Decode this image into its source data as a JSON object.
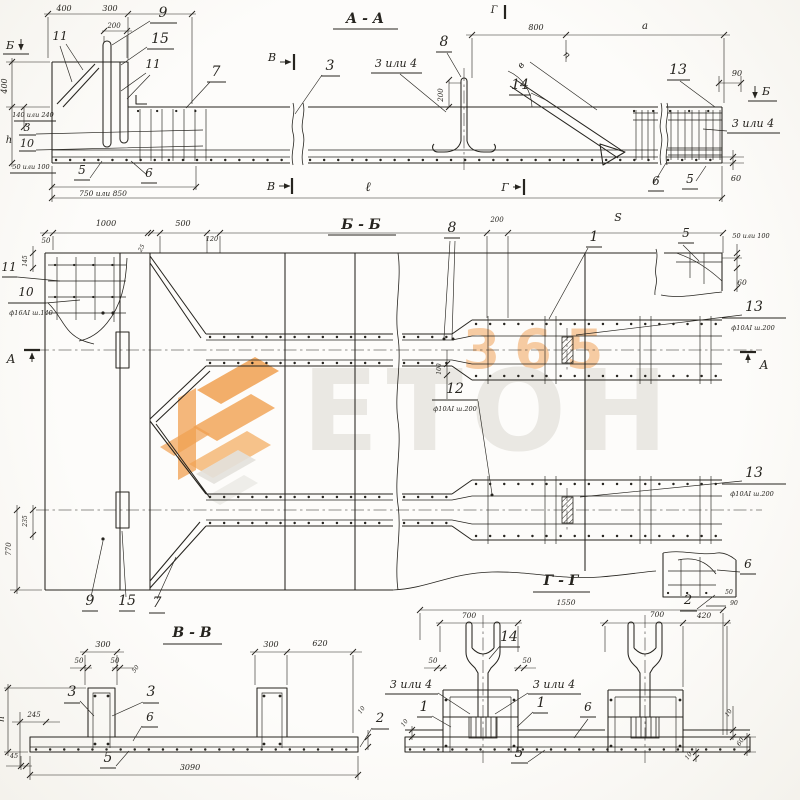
{
  "colors": {
    "ink": "#26241f",
    "paper": "#fdfcfa",
    "watermark_orange": "#f0a050",
    "watermark_gray": "#e8e6e1"
  },
  "watermark": {
    "digits": "365",
    "word": "ЕТОН"
  },
  "annotations": {
    "aa": [
      {
        "n": "title",
        "t": "А - А",
        "x": 365,
        "y": 23,
        "fs": 14,
        "b": 1
      },
      {
        "n": "mark-b-left",
        "t": "Б",
        "x": 10,
        "y": 49,
        "fs": 11
      },
      {
        "n": "dim-400-top",
        "t": "400",
        "x": 64,
        "y": 11,
        "fs": 8
      },
      {
        "n": "dim-300-top",
        "t": "300",
        "x": 110,
        "y": 11,
        "fs": 8
      },
      {
        "n": "dim-200-top",
        "t": "200",
        "x": 114,
        "y": 28,
        "fs": 7
      },
      {
        "n": "callout-9",
        "t": "9",
        "x": 163,
        "y": 17,
        "fs": 14
      },
      {
        "n": "callout-15",
        "t": "15",
        "x": 160,
        "y": 43,
        "fs": 14
      },
      {
        "n": "callout-11a",
        "t": "11",
        "x": 60,
        "y": 40,
        "fs": 12
      },
      {
        "n": "callout-11b",
        "t": "11",
        "x": 153,
        "y": 68,
        "fs": 12
      },
      {
        "n": "callout-7",
        "t": "7",
        "x": 216,
        "y": 76,
        "fs": 14
      },
      {
        "n": "dim-400-left",
        "t": "400",
        "x": 7,
        "y": 86,
        "fs": 8,
        "r": -90
      },
      {
        "n": "dim-140-240",
        "t": "140 или 240",
        "x": 33,
        "y": 117,
        "fs": 6.5
      },
      {
        "n": "callout-3a",
        "t": "3",
        "x": 27,
        "y": 131,
        "fs": 11
      },
      {
        "n": "callout-10",
        "t": "10",
        "x": 27,
        "y": 147,
        "fs": 11
      },
      {
        "n": "dim-h",
        "t": "h",
        "x": 9,
        "y": 143,
        "fs": 10
      },
      {
        "n": "dim-50-100",
        "t": "50 или 100",
        "x": 31,
        "y": 169,
        "fs": 6.5
      },
      {
        "n": "callout-5a",
        "t": "5",
        "x": 82,
        "y": 174,
        "fs": 12
      },
      {
        "n": "callout-6a",
        "t": "6",
        "x": 149,
        "y": 177,
        "fs": 12
      },
      {
        "n": "dim-750-850",
        "t": "750 или 850",
        "x": 103,
        "y": 196,
        "fs": 7.5
      },
      {
        "n": "mark-v-top",
        "t": "В",
        "x": 272,
        "y": 61,
        "fs": 11
      },
      {
        "n": "callout-3b",
        "t": "3",
        "x": 330,
        "y": 70,
        "fs": 14
      },
      {
        "n": "callout-3or4a",
        "t": "3 или 4",
        "x": 396,
        "y": 67,
        "fs": 11
      },
      {
        "n": "callout-8",
        "t": "8",
        "x": 444,
        "y": 46,
        "fs": 14
      },
      {
        "n": "dim-200-mid",
        "t": "200",
        "x": 443,
        "y": 95,
        "fs": 7,
        "r": -90
      },
      {
        "n": "dim-800",
        "t": "800",
        "x": 536,
        "y": 30,
        "fs": 8
      },
      {
        "n": "dim-a",
        "t": "а",
        "x": 645,
        "y": 29,
        "fs": 10
      },
      {
        "n": "dim-n",
        "t": "п",
        "x": 565,
        "y": 57,
        "fs": 9,
        "r": 42
      },
      {
        "n": "dim-v-angle",
        "t": "в",
        "x": 523,
        "y": 67,
        "fs": 9,
        "r": -50
      },
      {
        "n": "callout-14",
        "t": "14",
        "x": 520,
        "y": 89,
        "fs": 14
      },
      {
        "n": "mark-g-top",
        "t": "Г",
        "x": 494,
        "y": 13,
        "fs": 10
      },
      {
        "n": "callout-13",
        "t": "13",
        "x": 678,
        "y": 74,
        "fs": 14
      },
      {
        "n": "dim-90",
        "t": "90",
        "x": 737,
        "y": 76,
        "fs": 8
      },
      {
        "n": "mark-b-right",
        "t": "Б",
        "x": 766,
        "y": 95,
        "fs": 11
      },
      {
        "n": "callout-3or4b",
        "t": "3 или 4",
        "x": 753,
        "y": 127,
        "fs": 11
      },
      {
        "n": "callout-6b",
        "t": "6",
        "x": 656,
        "y": 185,
        "fs": 12
      },
      {
        "n": "callout-5b",
        "t": "5",
        "x": 690,
        "y": 183,
        "fs": 12
      },
      {
        "n": "dim-60",
        "t": "60",
        "x": 736,
        "y": 181,
        "fs": 8
      },
      {
        "n": "mark-v-bot",
        "t": "В",
        "x": 271,
        "y": 190,
        "fs": 11
      },
      {
        "n": "dim-length",
        "t": "ℓ",
        "x": 368,
        "y": 191,
        "fs": 13
      },
      {
        "n": "mark-g-bot",
        "t": "Г",
        "x": 505,
        "y": 191,
        "fs": 11
      }
    ],
    "bb": [
      {
        "n": "title",
        "t": "Б - Б",
        "x": 361,
        "y": 229,
        "fs": 14,
        "b": 1
      },
      {
        "n": "dim-50",
        "t": "50",
        "x": 46,
        "y": 243,
        "fs": 7
      },
      {
        "n": "dim-1000",
        "t": "1000",
        "x": 106,
        "y": 226,
        "fs": 8
      },
      {
        "n": "dim-500",
        "t": "500",
        "x": 183,
        "y": 226,
        "fs": 8
      },
      {
        "n": "dim-25",
        "t": "25",
        "x": 143,
        "y": 249,
        "fs": 6,
        "r": -60
      },
      {
        "n": "dim-120",
        "t": "120",
        "x": 212,
        "y": 241,
        "fs": 6.5
      },
      {
        "n": "callout-8",
        "t": "8",
        "x": 452,
        "y": 232,
        "fs": 14
      },
      {
        "n": "dim-200",
        "t": "200",
        "x": 497,
        "y": 222,
        "fs": 7
      },
      {
        "n": "dim-S",
        "t": "S",
        "x": 618,
        "y": 221,
        "fs": 11
      },
      {
        "n": "callout-5",
        "t": "5",
        "x": 686,
        "y": 237,
        "fs": 12
      },
      {
        "n": "dim-50-100",
        "t": "50 или 100",
        "x": 751,
        "y": 238,
        "fs": 6.5
      },
      {
        "n": "dim-60",
        "t": "60",
        "x": 742,
        "y": 285,
        "fs": 7.5
      },
      {
        "n": "callout-11",
        "t": "11",
        "x": 9,
        "y": 271,
        "fs": 12
      },
      {
        "n": "callout-10",
        "t": "10",
        "x": 26,
        "y": 296,
        "fs": 12
      },
      {
        "n": "spec-f16",
        "t": "ф16АI ш.140",
        "x": 31,
        "y": 315,
        "fs": 6.5
      },
      {
        "n": "dim-145",
        "t": "145",
        "x": 27,
        "y": 261,
        "fs": 6,
        "r": -90
      },
      {
        "n": "mark-a-left",
        "t": "А",
        "x": 11,
        "y": 363,
        "fs": 12
      },
      {
        "n": "callout-13-top",
        "t": "13",
        "x": 754,
        "y": 311,
        "fs": 14
      },
      {
        "n": "spec-13-top",
        "t": "ф10АI ш.200",
        "x": 753,
        "y": 330,
        "fs": 6.5
      },
      {
        "n": "callout-12",
        "t": "12",
        "x": 455,
        "y": 393,
        "fs": 14
      },
      {
        "n": "spec-12",
        "t": "ф10АI ш.200",
        "x": 455,
        "y": 411,
        "fs": 6.5
      },
      {
        "n": "dim-100",
        "t": "100",
        "x": 441,
        "y": 369,
        "fs": 6,
        "r": -90
      },
      {
        "n": "callout-13-bot",
        "t": "13",
        "x": 754,
        "y": 477,
        "fs": 14
      },
      {
        "n": "spec-13-bot",
        "t": "ф10АI ш.200",
        "x": 752,
        "y": 496,
        "fs": 6.5
      },
      {
        "n": "mark-a-right",
        "t": "А",
        "x": 764,
        "y": 369,
        "fs": 12
      },
      {
        "n": "dim-770",
        "t": "770",
        "x": 11,
        "y": 549,
        "fs": 7,
        "r": -90
      },
      {
        "n": "dim-235",
        "t": "235",
        "x": 27,
        "y": 521,
        "fs": 6,
        "r": -90
      },
      {
        "n": "callout-9",
        "t": "9",
        "x": 90,
        "y": 605,
        "fs": 14
      },
      {
        "n": "callout-15",
        "t": "15",
        "x": 127,
        "y": 605,
        "fs": 14
      },
      {
        "n": "callout-7",
        "t": "7",
        "x": 157,
        "y": 607,
        "fs": 14
      },
      {
        "n": "callout-6",
        "t": "6",
        "x": 748,
        "y": 568,
        "fs": 12
      },
      {
        "n": "callout-2",
        "t": "2",
        "x": 688,
        "y": 604,
        "fs": 13
      },
      {
        "n": "dim-50-corner",
        "t": "50",
        "x": 729,
        "y": 594,
        "fs": 6
      },
      {
        "n": "dim-90-corner",
        "t": "90",
        "x": 734,
        "y": 605,
        "fs": 6
      },
      {
        "n": "callout-1",
        "t": "1",
        "x": 594,
        "y": 241,
        "fs": 14
      }
    ],
    "vv": [
      {
        "n": "title",
        "t": "В - В",
        "x": 192,
        "y": 637,
        "fs": 14,
        "b": 1
      },
      {
        "n": "dim-300-left",
        "t": "300",
        "x": 103,
        "y": 647,
        "fs": 8
      },
      {
        "n": "dim-50-left",
        "t": "50",
        "x": 79,
        "y": 663,
        "fs": 7
      },
      {
        "n": "dim-50-right",
        "t": "50",
        "x": 115,
        "y": 663,
        "fs": 7
      },
      {
        "n": "dim-50-rot",
        "t": "50",
        "x": 137,
        "y": 670,
        "fs": 6,
        "r": -55
      },
      {
        "n": "callout-3-left",
        "t": "3",
        "x": 72,
        "y": 696,
        "fs": 14
      },
      {
        "n": "callout-3-right",
        "t": "3",
        "x": 151,
        "y": 696,
        "fs": 14
      },
      {
        "n": "dim-245",
        "t": "245",
        "x": 34,
        "y": 717,
        "fs": 7
      },
      {
        "n": "callout-6",
        "t": "6",
        "x": 150,
        "y": 721,
        "fs": 12
      },
      {
        "n": "dim-h",
        "t": "h",
        "x": 4,
        "y": 719,
        "fs": 9,
        "r": -90
      },
      {
        "n": "dim-45",
        "t": "45",
        "x": 14,
        "y": 758,
        "fs": 6.5
      },
      {
        "n": "callout-5",
        "t": "5",
        "x": 108,
        "y": 762,
        "fs": 14
      },
      {
        "n": "dim-3090",
        "t": "3090",
        "x": 190,
        "y": 770,
        "fs": 8
      },
      {
        "n": "dim-300-right",
        "t": "300",
        "x": 271,
        "y": 647,
        "fs": 8
      },
      {
        "n": "dim-620",
        "t": "620",
        "x": 320,
        "y": 646,
        "fs": 8
      },
      {
        "n": "dim-10",
        "t": "10",
        "x": 363,
        "y": 711,
        "fs": 6,
        "r": -55
      },
      {
        "n": "callout-2",
        "t": "2",
        "x": 380,
        "y": 722,
        "fs": 13
      }
    ],
    "gg": [
      {
        "n": "title",
        "t": "Г - Г",
        "x": 561,
        "y": 585,
        "fs": 14,
        "b": 1
      },
      {
        "n": "dim-1550",
        "t": "1550",
        "x": 566,
        "y": 605,
        "fs": 7.5
      },
      {
        "n": "dim-700-left",
        "t": "700",
        "x": 469,
        "y": 618,
        "fs": 7.5
      },
      {
        "n": "callout-14",
        "t": "14",
        "x": 509,
        "y": 641,
        "fs": 14
      },
      {
        "n": "dim-50-left",
        "t": "50",
        "x": 433,
        "y": 663,
        "fs": 7
      },
      {
        "n": "dim-50-right",
        "t": "50",
        "x": 527,
        "y": 663,
        "fs": 7
      },
      {
        "n": "callout-3or4-left",
        "t": "3 или 4",
        "x": 411,
        "y": 688,
        "fs": 11
      },
      {
        "n": "callout-3or4-right",
        "t": "3 или 4",
        "x": 554,
        "y": 688,
        "fs": 11
      },
      {
        "n": "callout-1-left",
        "t": "1",
        "x": 424,
        "y": 711,
        "fs": 14
      },
      {
        "n": "callout-1-right",
        "t": "1",
        "x": 541,
        "y": 707,
        "fs": 14
      },
      {
        "n": "callout-6",
        "t": "6",
        "x": 588,
        "y": 711,
        "fs": 12
      },
      {
        "n": "dim-10-left",
        "t": "10",
        "x": 406,
        "y": 724,
        "fs": 6,
        "r": -55
      },
      {
        "n": "callout-5",
        "t": "5",
        "x": 519,
        "y": 757,
        "fs": 14
      },
      {
        "n": "dim-700-right",
        "t": "700",
        "x": 657,
        "y": 617,
        "fs": 7.5
      },
      {
        "n": "dim-420",
        "t": "420",
        "x": 704,
        "y": 618,
        "fs": 7.5
      },
      {
        "n": "dim-10-right",
        "t": "10",
        "x": 730,
        "y": 714,
        "fs": 6,
        "r": -55
      },
      {
        "n": "dim-60",
        "t": "60",
        "x": 742,
        "y": 743,
        "fs": 6.5,
        "r": -55
      },
      {
        "n": "dim-10-bottom",
        "t": "10",
        "x": 690,
        "y": 757,
        "fs": 6,
        "r": -55
      }
    ]
  }
}
